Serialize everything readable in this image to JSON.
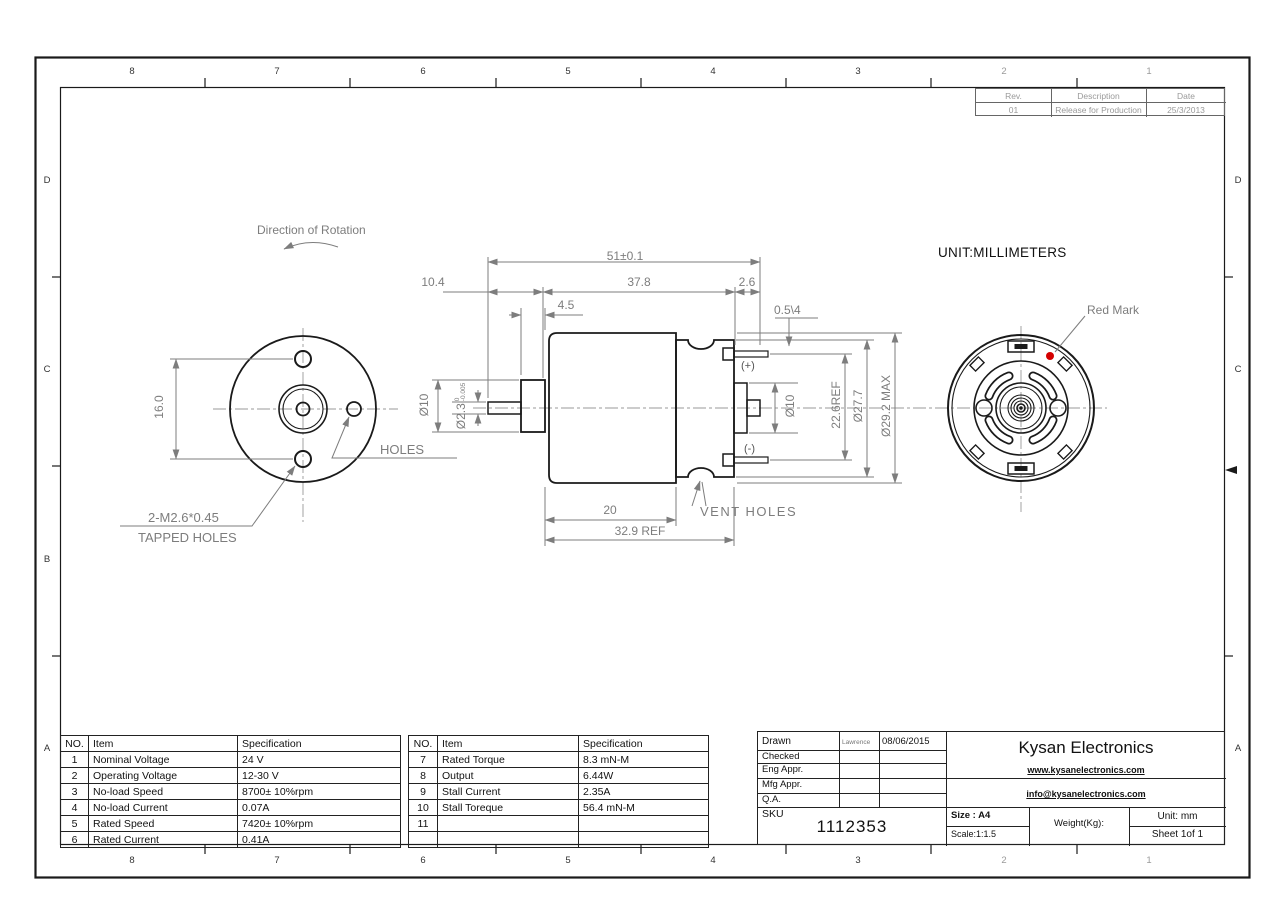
{
  "page": {
    "unit_note": "UNIT:MILLIMETERS"
  },
  "border": {
    "top_numbers": [
      "8",
      "7",
      "6",
      "5",
      "4",
      "3",
      "2",
      "1"
    ],
    "bottom_numbers": [
      "8",
      "7",
      "6",
      "5",
      "4",
      "3",
      "2",
      "1"
    ],
    "left_letters": [
      "D",
      "C",
      "B",
      "A"
    ],
    "right_letters": [
      "D",
      "C",
      "A"
    ]
  },
  "revision_table": {
    "headers": [
      "Rev.",
      "Description",
      "Date"
    ],
    "rows": [
      [
        "01",
        "Release for Production",
        "25/3/2013"
      ]
    ]
  },
  "front_view": {
    "rotation_label": "Direction of Rotation",
    "dim_16": "16.0",
    "tapped_line1": "2-M2.6*0.45",
    "tapped_line2": "TAPPED HOLES",
    "holes_label": "HOLES"
  },
  "side_view": {
    "dim_51": "51±0.1",
    "dim_10_4": "10.4",
    "dim_37_8": "37.8",
    "dim_2_6": "2.6",
    "dim_4_5": "4.5",
    "dim_0_5_4": "0.5\\4",
    "dia_10_left": "Ø10",
    "dia_2_3": "Ø2.3",
    "dia_2_3_tol_upper": "0",
    "dia_2_3_tol_lower": "-0.005",
    "dia_10_right": "Ø10",
    "dim_22_6": "22.6REF",
    "dia_27_7": "Ø27.7",
    "dia_29_2": "Ø29.2 MAX",
    "dim_20": "20",
    "dim_32_9": "32.9 REF",
    "plus": "(+)",
    "minus": "(-)",
    "vent_holes": "VENT HOLES"
  },
  "rear_view": {
    "red_mark": "Red Mark"
  },
  "spec_table_left": {
    "headers": [
      "NO.",
      "Item",
      "Specification"
    ],
    "rows": [
      [
        "1",
        "Nominal Voltage",
        "24 V"
      ],
      [
        "2",
        "Operating Voltage",
        "12-30 V"
      ],
      [
        "3",
        "No-load Speed",
        "8700± 10%rpm"
      ],
      [
        "4",
        "No-load Current",
        "0.07A"
      ],
      [
        "5",
        "Rated Speed",
        "7420± 10%rpm"
      ],
      [
        "6",
        "Rated Current",
        "0.41A"
      ]
    ]
  },
  "spec_table_right": {
    "headers": [
      "NO.",
      "Item",
      "Specification"
    ],
    "rows": [
      [
        "7",
        "Rated Torque",
        "8.3 mN-M"
      ],
      [
        "8",
        "Output",
        "6.44W"
      ],
      [
        "9",
        "Stall Current",
        "2.35A"
      ],
      [
        "10",
        "Stall Toreque",
        "56.4 mN-M"
      ],
      [
        "11",
        "",
        ""
      ],
      [
        "",
        "",
        ""
      ]
    ]
  },
  "title_block": {
    "rows": [
      {
        "label": "Drawn",
        "name": "Lawrence",
        "date": "08/06/2015"
      },
      {
        "label": "Checked",
        "name": "",
        "date": ""
      },
      {
        "label": "Eng Appr.",
        "name": "",
        "date": ""
      },
      {
        "label": "Mfg Appr.",
        "name": "",
        "date": ""
      },
      {
        "label": "Q.A.",
        "name": "",
        "date": ""
      }
    ],
    "sku_label": "SKU",
    "sku_value": "1112353",
    "company": "Kysan Electronics",
    "website": "www.kysanelectronics.com",
    "email": "info@kysanelectronics.com",
    "size": "Size : A4",
    "scale": "Scale:1:1.5",
    "weight_label": "Weight(Kg):",
    "unit": "Unit: mm",
    "sheet": "Sheet 1of 1"
  },
  "colors": {
    "line": "#1a1a1a",
    "dim": "#7d7d7d",
    "red_mark": "#d40000"
  }
}
